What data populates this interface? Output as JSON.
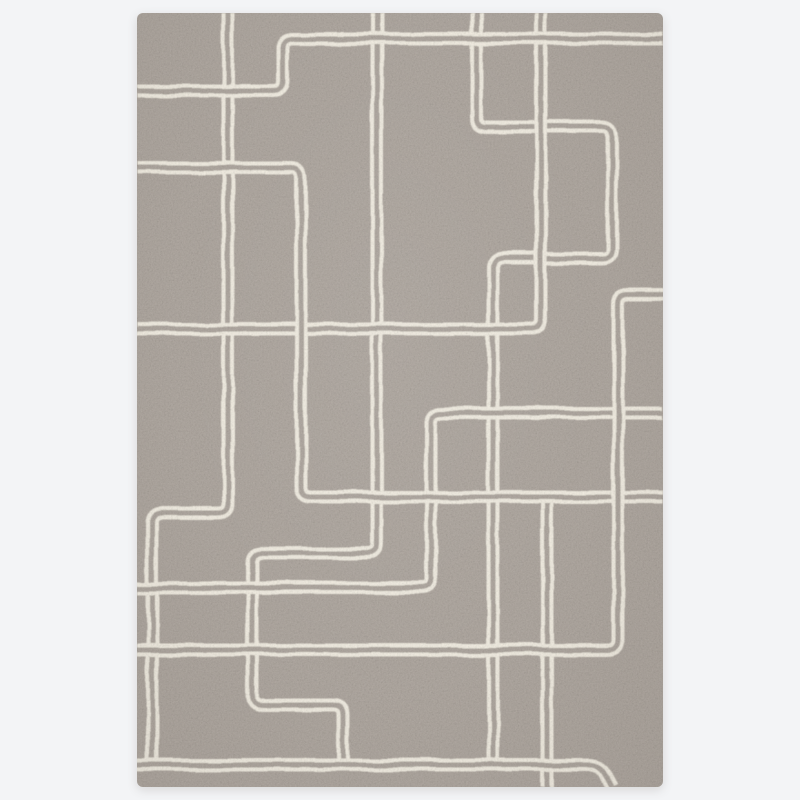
{
  "scene": {
    "background_color": "#f3f4f6",
    "shadow_color": "rgba(90,84,78,0.18)"
  },
  "rug": {
    "left": 137,
    "top": 13,
    "width": 526,
    "height": 774,
    "corner_radius": 6,
    "base_color": "#a8a098",
    "line_color": "#f0ebdf",
    "grain_dark_opacity": 0.28,
    "grain_light_opacity": 0.2
  },
  "pattern": {
    "band_width": 13,
    "gap_width": 5,
    "corner_radius": 10,
    "paths": [
      {
        "name": "bottom-stub-vertical",
        "points": [
          [
            410,
            484
          ],
          [
            410,
            774
          ]
        ]
      },
      {
        "name": "left-vertical-zigzag",
        "points": [
          [
            91,
            0
          ],
          [
            91,
            500
          ],
          [
            15,
            500
          ],
          [
            15,
            752
          ]
        ]
      },
      {
        "name": "center-vertical-zigzag",
        "points": [
          [
            240,
            0
          ],
          [
            240,
            540
          ],
          [
            115,
            540
          ],
          [
            115,
            692
          ],
          [
            206,
            692
          ],
          [
            206,
            752
          ]
        ]
      },
      {
        "name": "right-top-meander",
        "points": [
          [
            340,
            0
          ],
          [
            340,
            114
          ],
          [
            475,
            114
          ],
          [
            475,
            245
          ],
          [
            356,
            245
          ],
          [
            356,
            752
          ]
        ]
      },
      {
        "name": "mid-right-hook",
        "points": [
          [
            526,
            400
          ],
          [
            294,
            400
          ],
          [
            294,
            575
          ],
          [
            0,
            575
          ]
        ]
      },
      {
        "name": "fifth-vertical-to-left",
        "points": [
          [
            404,
            0
          ],
          [
            404,
            316
          ],
          [
            0,
            316
          ]
        ]
      },
      {
        "name": "left-mid-hook",
        "points": [
          [
            0,
            155
          ],
          [
            164,
            155
          ],
          [
            164,
            484
          ],
          [
            526,
            484
          ]
        ]
      },
      {
        "name": "right-edge-meander",
        "points": [
          [
            526,
            281
          ],
          [
            481,
            281
          ],
          [
            481,
            637
          ],
          [
            0,
            637
          ]
        ]
      },
      {
        "name": "top-left-hook",
        "points": [
          [
            0,
            78
          ],
          [
            146,
            78
          ],
          [
            146,
            26
          ],
          [
            526,
            26
          ]
        ]
      },
      {
        "name": "bottom-border",
        "points": [
          [
            0,
            752
          ],
          [
            463,
            752
          ],
          [
            475,
            774
          ]
        ]
      }
    ]
  }
}
